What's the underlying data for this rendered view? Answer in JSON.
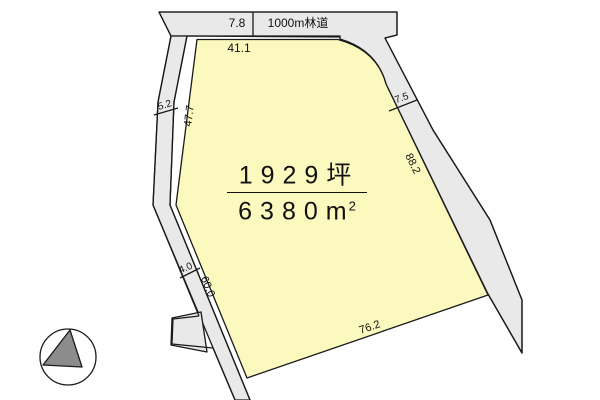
{
  "map": {
    "title_road": {
      "width_label": "7.8",
      "name": "1000m林道"
    },
    "parcel": {
      "area_tsubo": "1929坪",
      "area_m2_base": "6380m",
      "area_m2_sup": "2"
    },
    "dimensions": {
      "top_edge": "41.1",
      "left_road_width": "5.2",
      "left_edge": "47.7",
      "right_road_width": "7.5",
      "right_edge": "88.2",
      "lower_left_road_width": "4.0",
      "lower_left_edge": "60.0",
      "bottom_edge": "76.2"
    },
    "colors": {
      "parcel_fill": "#fcf9be",
      "road_fill": "#e9e9e9",
      "line": "#1a1a1a",
      "compass_fill": "#8c8c8c",
      "background": "#ffffff"
    },
    "icons": {
      "compass": "north-arrow-compass"
    }
  }
}
